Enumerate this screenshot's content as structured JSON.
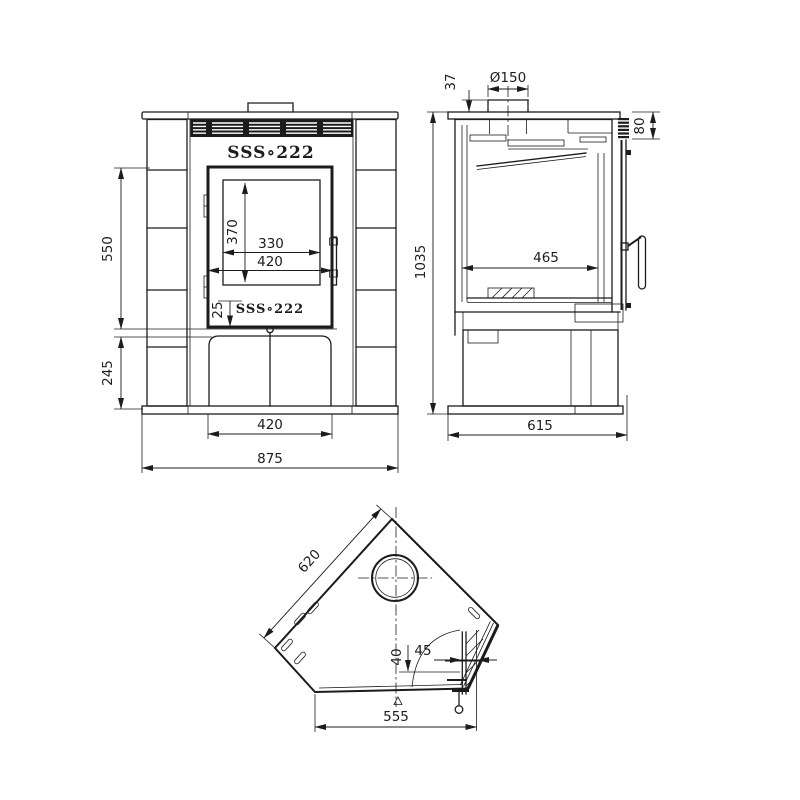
{
  "drawing": {
    "type": "technical drawing - corner stove, three orthographic views",
    "background": "#ffffff",
    "line_color": "#1c1c1c",
    "front_view": {
      "label": "front view",
      "logo": "SSS∘222",
      "dimensions": {
        "upper_height": "550",
        "lower_height": "245",
        "glass_height": "370",
        "glass_width": "330",
        "door_width": "420",
        "logo_offset": "25",
        "base_width": "420",
        "overall_width": "875"
      }
    },
    "side_view": {
      "label": "side view",
      "dimensions": {
        "flue_diameter": "Ø150",
        "flue_stub_height": "37",
        "grille_height": "80",
        "overall_height": "1035",
        "firebox_depth": "465",
        "overall_depth": "615"
      }
    },
    "top_view": {
      "label": "top view",
      "dimensions": {
        "back_edge": "620",
        "hinge_depth": "40",
        "hinge_gap": "45",
        "front_width": "555"
      }
    }
  }
}
